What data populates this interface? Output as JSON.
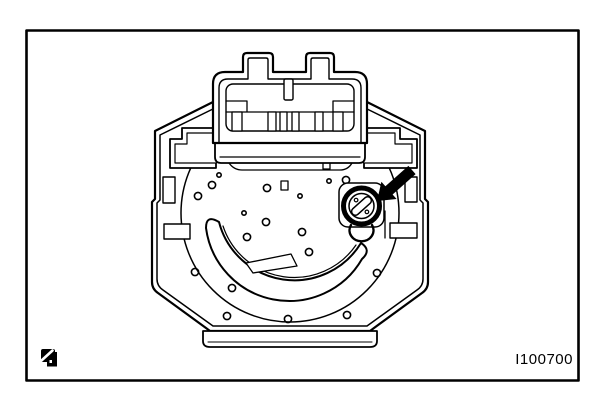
{
  "figure": {
    "reference_code": "I100700"
  },
  "colors": {
    "ink": "#000000",
    "paper": "#ffffff"
  },
  "icons": {
    "corner_glyph": "manual-reference-icon",
    "callout": "arrow-icon"
  }
}
